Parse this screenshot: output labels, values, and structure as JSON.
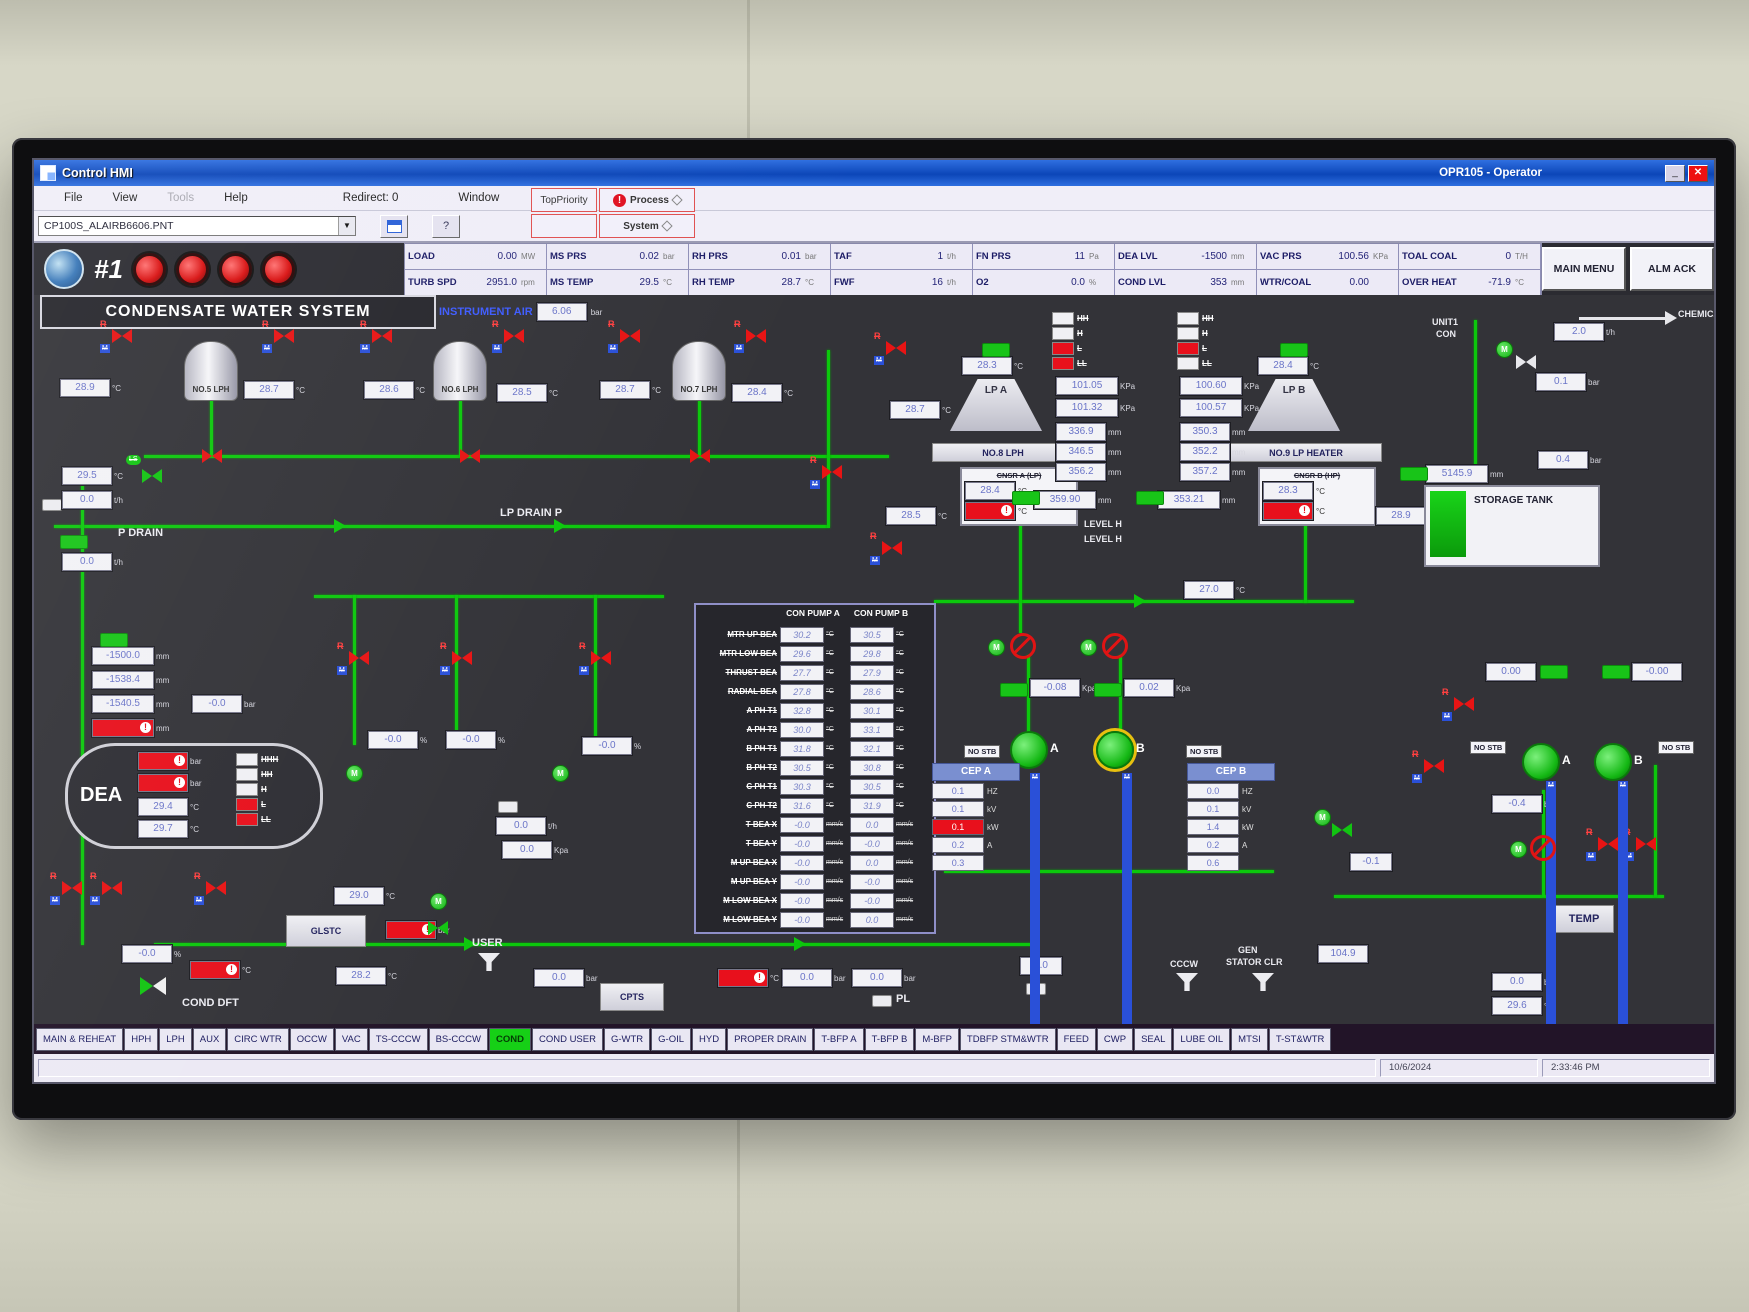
{
  "window": {
    "app_title": "Control HMI",
    "operator": "OPR105 - Operator",
    "minimize": "_",
    "close": "✕"
  },
  "menu": {
    "items": [
      {
        "label": "File"
      },
      {
        "label": "View"
      },
      {
        "label": "Tools",
        "cls": "disabled"
      },
      {
        "label": "Help"
      }
    ],
    "redirect": "Redirect: 0",
    "window_menu": "Window",
    "top_priority": "TopPriority",
    "process": "Process",
    "system": "System"
  },
  "toolbar": {
    "file_name": "CP100S_ALAIRB6606.PNT",
    "help": "?"
  },
  "header": {
    "unit_no": "#1",
    "kpis": [
      {
        "label": "LOAD",
        "value": "0.00",
        "unit": "MW"
      },
      {
        "label": "MS PRS",
        "value": "0.02",
        "unit": "bar"
      },
      {
        "label": "RH PRS",
        "value": "0.01",
        "unit": "bar"
      },
      {
        "label": "TAF",
        "value": "1",
        "unit": "t/h"
      },
      {
        "label": "FN PRS",
        "value": "11",
        "unit": "Pa"
      },
      {
        "label": "DEA LVL",
        "value": "-1500",
        "unit": "mm"
      },
      {
        "label": "VAC PRS",
        "value": "100.56",
        "unit": "KPa"
      },
      {
        "label": "TOAL COAL",
        "value": "0",
        "unit": "T/H"
      },
      {
        "label": "TURB SPD",
        "value": "2951.0",
        "unit": "rpm"
      },
      {
        "label": "MS TEMP",
        "value": "29.5",
        "unit": "°C"
      },
      {
        "label": "RH TEMP",
        "value": "28.7",
        "unit": "°C"
      },
      {
        "label": "FWF",
        "value": "16",
        "unit": "t/h"
      },
      {
        "label": "O2",
        "value": "0.0",
        "unit": "%"
      },
      {
        "label": "COND LVL",
        "value": "353",
        "unit": "mm"
      },
      {
        "label": "WTR/COAL",
        "value": "0.00",
        "unit": ""
      },
      {
        "label": "OVER HEAT",
        "value": "-71.9",
        "unit": "°C"
      }
    ],
    "main_menu": "MAIN MENU",
    "alm_ack": "ALM ACK"
  },
  "mimic": {
    "title": "CONDENSATE WATER SYSTEM",
    "ia_label": "INSTRUMENT AIR",
    "ia_v": "6.06",
    "u_c": "°C",
    "u_mm": "mm",
    "u_bar": "bar",
    "u_th": "t/h",
    "u_kpa": "KPa",
    "u_kpa2": "Kpa",
    "u_pct": "%",
    "heaters": [
      {
        "name": "NO.5 LPH",
        "lt": "28.9",
        "rt": "28.7"
      },
      {
        "name": "NO.6 LPH",
        "lt": "28.6",
        "rt": "28.5"
      },
      {
        "name": "NO.7 LPH",
        "lt": "28.7",
        "rt": "28.4"
      }
    ],
    "s287": "28.7",
    "lp_drain_label": "LP DRAIN P",
    "pdrain": {
      "label": "P DRAIN",
      "t": "29.5",
      "f1": "0.0",
      "f2": "0.0"
    },
    "t270": "27.0",
    "dea": {
      "l1": "-1500.0",
      "l2": "-1538.4",
      "l3": "-1540.5",
      "p": "-0.0",
      "name": "DEA",
      "t1": "29.4",
      "t2": "29.7",
      "levels": [
        {
          "t": "HHH"
        },
        {
          "t": "HH"
        },
        {
          "t": "H"
        },
        {
          "t": "L",
          "cls": "red"
        },
        {
          "t": "LL",
          "cls": "red"
        }
      ]
    },
    "cluster": {
      "p1": "-0.0",
      "p2": "-0.0",
      "p3": "-0.0",
      "f": "0.0",
      "k": "0.0"
    },
    "glstc": {
      "t": "29.0",
      "label": "GLSTC",
      "t2": "28.2"
    },
    "user_label": "USER",
    "user_p": "0.0",
    "cpts": "CPTS",
    "pl": "PL",
    "cond_dft": {
      "label": "COND DFT",
      "pct": "-0.0"
    },
    "bot": {
      "b1": "0.0",
      "b2": "0.0",
      "b3": "0.0"
    },
    "table": {
      "col_a": "CON PUMP A",
      "col_b": "CON PUMP B",
      "rows": [
        {
          "label": "MTR UP BEA",
          "a": "30.2",
          "au": "°C",
          "b": "30.5",
          "bu": "°C"
        },
        {
          "label": "MTR LOW BEA",
          "a": "29.6",
          "au": "°C",
          "b": "29.8",
          "bu": "°C"
        },
        {
          "label": "THRUST BEA",
          "a": "27.7",
          "au": "°C",
          "b": "27.9",
          "bu": "°C"
        },
        {
          "label": "RADIAL BEA",
          "a": "27.8",
          "au": "°C",
          "b": "28.6",
          "bu": "°C"
        },
        {
          "label": "A PH T1",
          "a": "32.8",
          "au": "°C",
          "b": "30.1",
          "bu": "°C"
        },
        {
          "label": "A PH T2",
          "a": "30.0",
          "au": "°C",
          "b": "33.1",
          "bu": "°C"
        },
        {
          "label": "B PH T1",
          "a": "31.8",
          "au": "°C",
          "b": "32.1",
          "bu": "°C"
        },
        {
          "label": "B PH T2",
          "a": "30.5",
          "au": "°C",
          "b": "30.8",
          "bu": "°C"
        },
        {
          "label": "C PH T1",
          "a": "30.3",
          "au": "°C",
          "b": "30.5",
          "bu": "°C"
        },
        {
          "label": "C PH T2",
          "a": "31.6",
          "au": "°C",
          "b": "31.9",
          "bu": "°C"
        },
        {
          "label": "T BEA X",
          "a": "-0.0",
          "au": "mm/s",
          "b": "0.0",
          "bu": "mm/s"
        },
        {
          "label": "T BEA Y",
          "a": "-0.0",
          "au": "mm/s",
          "b": "-0.0",
          "bu": "mm/s"
        },
        {
          "label": "M UP BEA X",
          "a": "-0.0",
          "au": "mm/s",
          "b": "0.0",
          "bu": "mm/s"
        },
        {
          "label": "M UP BEA Y",
          "a": "-0.0",
          "au": "mm/s",
          "b": "-0.0",
          "bu": "mm/s"
        },
        {
          "label": "M LOW BEA X",
          "a": "-0.0",
          "au": "mm/s",
          "b": "-0.0",
          "bu": "mm/s"
        },
        {
          "label": "M LOW BEA Y",
          "a": "-0.0",
          "au": "mm/s",
          "b": "0.0",
          "bu": "mm/s"
        }
      ]
    },
    "cnsr_a": {
      "t": "28.3",
      "funnel": "LP A",
      "plate": "NO.8 LPH",
      "name": "CNSR A (LP)",
      "ct": "28.4",
      "lt": "28.5",
      "p1": "101.05",
      "p2": "101.32",
      "m1": "336.9",
      "m2": "346.5",
      "m3": "356.2",
      "lvl": "359.90",
      "lh1": "LEVEL H",
      "lh2": "LEVEL H",
      "levels": [
        {
          "t": "HH"
        },
        {
          "t": "H"
        },
        {
          "t": "L",
          "cls": "red"
        },
        {
          "t": "LL",
          "cls": "red"
        }
      ]
    },
    "cnsr_b": {
      "t": "28.4",
      "funnel": "LP B",
      "plate": "NO.9 LP HEATER",
      "name": "CNSR B (HP)",
      "ct": "28.3",
      "rt": "28.9",
      "p1": "100.60",
      "p2": "100.57",
      "m1": "350.3",
      "m2": "352.2",
      "m3": "357.2",
      "lvl": "353.21",
      "levels": [
        {
          "t": "HH"
        },
        {
          "t": "H"
        },
        {
          "t": "L",
          "cls": "red"
        },
        {
          "t": "LL"
        }
      ]
    },
    "cep": {
      "a": {
        "title": "CEP A",
        "stb": "NO STB",
        "rows": [
          {
            "v": "0.1",
            "u": "HZ"
          },
          {
            "v": "0.1",
            "u": "kV"
          },
          {
            "v": "0.1",
            "u": "kW",
            "cls": "alarm"
          },
          {
            "v": "0.2",
            "u": "A"
          },
          {
            "v": "0.3",
            "u": ""
          }
        ]
      },
      "b": {
        "title": "CEP B",
        "stb": "NO STB",
        "rows": [
          {
            "v": "0.0",
            "u": "HZ"
          },
          {
            "v": "0.1",
            "u": "kV"
          },
          {
            "v": "1.4",
            "u": "kW"
          },
          {
            "v": "0.2",
            "u": "A"
          },
          {
            "v": "0.6",
            "u": ""
          }
        ]
      },
      "pa": "A",
      "pb": "B",
      "k1": "-0.08",
      "k2": "0.02"
    },
    "cccw": "CCCW",
    "gen1": "GEN",
    "gen2": "STATOR CLR",
    "v1049": "104.9",
    "right": {
      "unit1": "UNIT1",
      "unit2": "CON",
      "chem": "CHEMICAL",
      "f": "2.0",
      "p1": "0.1",
      "p2": "0.4",
      "tank": "STORAGE TANK",
      "lvl": "5145.9",
      "z1": "0.00",
      "z2": "-0.00",
      "stb1": "NO STB",
      "stb2": "NO STB",
      "pa": "A",
      "pb": "B",
      "v04": "-0.4",
      "v01": "-0.1",
      "temp": "TEMP",
      "bb": "0.0",
      "bt": "29.6"
    }
  },
  "tabs": [
    {
      "label": "MAIN & REHEAT"
    },
    {
      "label": "HPH"
    },
    {
      "label": "LPH"
    },
    {
      "label": "AUX"
    },
    {
      "label": "CIRC WTR"
    },
    {
      "label": "OCCW"
    },
    {
      "label": "VAC"
    },
    {
      "label": "TS-CCCW"
    },
    {
      "label": "BS-CCCW"
    },
    {
      "label": "COND",
      "cls": "active"
    },
    {
      "label": "COND USER"
    },
    {
      "label": "G-WTR"
    },
    {
      "label": "G-OIL"
    },
    {
      "label": "HYD"
    },
    {
      "label": "PROPER DRAIN"
    },
    {
      "label": "T-BFP A"
    },
    {
      "label": "T-BFP B"
    },
    {
      "label": "M-BFP"
    },
    {
      "label": "TDBFP STM&WTR"
    },
    {
      "label": "FEED"
    },
    {
      "label": "CWP"
    },
    {
      "label": "SEAL"
    },
    {
      "label": "LUBE OIL"
    },
    {
      "label": "MTSI"
    },
    {
      "label": "T-ST&WTR"
    }
  ],
  "statusbar": {
    "date": "10/6/2024",
    "time": "2:33:46 PM"
  }
}
